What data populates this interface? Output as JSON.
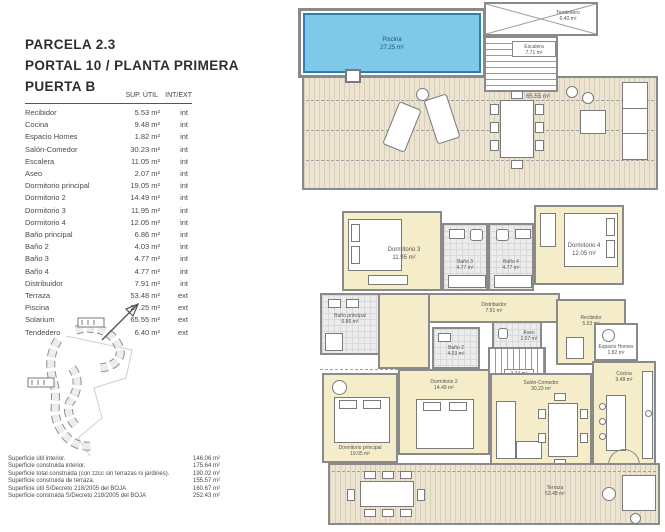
{
  "title": {
    "line1": "PARCELA 2.3",
    "line2": "PORTAL 10 / PLANTA PRIMERA",
    "line3": "PUERTA B"
  },
  "area_table": {
    "header_sup": "SUP. ÚTIL",
    "header_scope": "INT/EXT",
    "rows": [
      {
        "label": "Recibidor",
        "area": "5.53 m²",
        "scope": "int"
      },
      {
        "label": "Cocina",
        "area": "9.48 m²",
        "scope": "int"
      },
      {
        "label": "Espacio Homes",
        "area": "1.82 m²",
        "scope": "int"
      },
      {
        "label": "Salón-Comedor",
        "area": "30.23 m²",
        "scope": "int"
      },
      {
        "label": "Escalera",
        "area": "11.05 m²",
        "scope": "int"
      },
      {
        "label": "Aseo",
        "area": "2.07 m²",
        "scope": "int"
      },
      {
        "label": "Dormitorio principal",
        "area": "19.05 m²",
        "scope": "int"
      },
      {
        "label": "Dormitorio 2",
        "area": "14.49 m²",
        "scope": "int"
      },
      {
        "label": "Dormitorio 3",
        "area": "11.95 m²",
        "scope": "int"
      },
      {
        "label": "Dormitorio 4",
        "area": "12.05 m²",
        "scope": "int"
      },
      {
        "label": "Baño principal",
        "area": "6.86 m²",
        "scope": "int"
      },
      {
        "label": "Baño 2",
        "area": "4.03 m²",
        "scope": "int"
      },
      {
        "label": "Baño 3",
        "area": "4.77 m²",
        "scope": "int"
      },
      {
        "label": "Baño 4",
        "area": "4.77 m²",
        "scope": "int"
      },
      {
        "label": "Distribuidor",
        "area": "7.91 m²",
        "scope": "int"
      },
      {
        "label": "Terraza",
        "area": "53.48 m²",
        "scope": "ext"
      },
      {
        "label": "Piscina",
        "area": "27.25 m²",
        "scope": "ext"
      },
      {
        "label": "Solarium",
        "area": "65.55 m²",
        "scope": "ext"
      },
      {
        "label": "Tendedero",
        "area": "6.40 m²",
        "scope": "ext"
      }
    ]
  },
  "summary": {
    "rows": [
      {
        "label": "Superficie útil interior.",
        "value": "146.06 m²"
      },
      {
        "label": "Superficie construida interior.",
        "value": "175.64 m²"
      },
      {
        "label": "Superficie total construida (con zzcc sin terrazas ni jardines).",
        "value": "190.02 m²"
      },
      {
        "label": "Superficie construida de terraza.",
        "value": "155.57 m²"
      },
      {
        "label": "Superficie útil S/Decreto 218/2005 del BOJA",
        "value": "160.67 m²"
      },
      {
        "label": "Superficie construida S/Decreto 218/2005 del BOJA",
        "value": "252.43 m²"
      }
    ]
  },
  "upper_plan": {
    "piscina": {
      "name": "Piscina",
      "area": "27.25 m²"
    },
    "tendedero": {
      "name": "Tendedero",
      "area": "6.40 m²"
    },
    "escalera": {
      "name": "Escalera",
      "area": "7.71 m²"
    },
    "solarium": {
      "name": "Solarium",
      "area": "65.55 m²"
    }
  },
  "lower_plan": {
    "dormitorio3": {
      "name": "Dormitorio 3",
      "area": "11.95 m²"
    },
    "bano3": {
      "name": "Baño 3",
      "area": "4.77 m²"
    },
    "bano4": {
      "name": "Baño 4",
      "area": "4.77 m²"
    },
    "dormitorio4": {
      "name": "Dormitorio 4",
      "area": "12.05 m²"
    },
    "distribuidor": {
      "name": "Distribuidor",
      "area": "7.91 m²"
    },
    "bano_principal": {
      "name": "Baño principal",
      "area": "6.86 m²"
    },
    "aseo": {
      "name": "Aseo",
      "area": "2.07 m²"
    },
    "recibidor": {
      "name": "Recibidor",
      "area": "5.53 m²"
    },
    "bano2": {
      "name": "Baño 2",
      "area": "4.03 m²"
    },
    "escalera": {
      "name": "Escalera",
      "area": "3.34 m²"
    },
    "dormitorio2": {
      "name": "Dormitorio 2",
      "area": "14.49 m²"
    },
    "dormitorio_principal": {
      "name": "Dormitorio principal",
      "area": "19.05 m²"
    },
    "salon": {
      "name": "Salón-Comedor",
      "area": "30.23 m²"
    },
    "espacio_homes": {
      "name": "Espacio Homes",
      "area": "1.82 m²"
    },
    "cocina": {
      "name": "Cocina",
      "area": "9.48 m²"
    },
    "terraza": {
      "name": "Terraza",
      "area": "53.48 m²"
    }
  },
  "colors": {
    "wall": "#8a8a8a",
    "room": "#f5ecca",
    "pool": "#7fc9e8",
    "poolborder": "#2e7fae",
    "deck": "#ece4d1",
    "deckline": "#d8cfba"
  }
}
